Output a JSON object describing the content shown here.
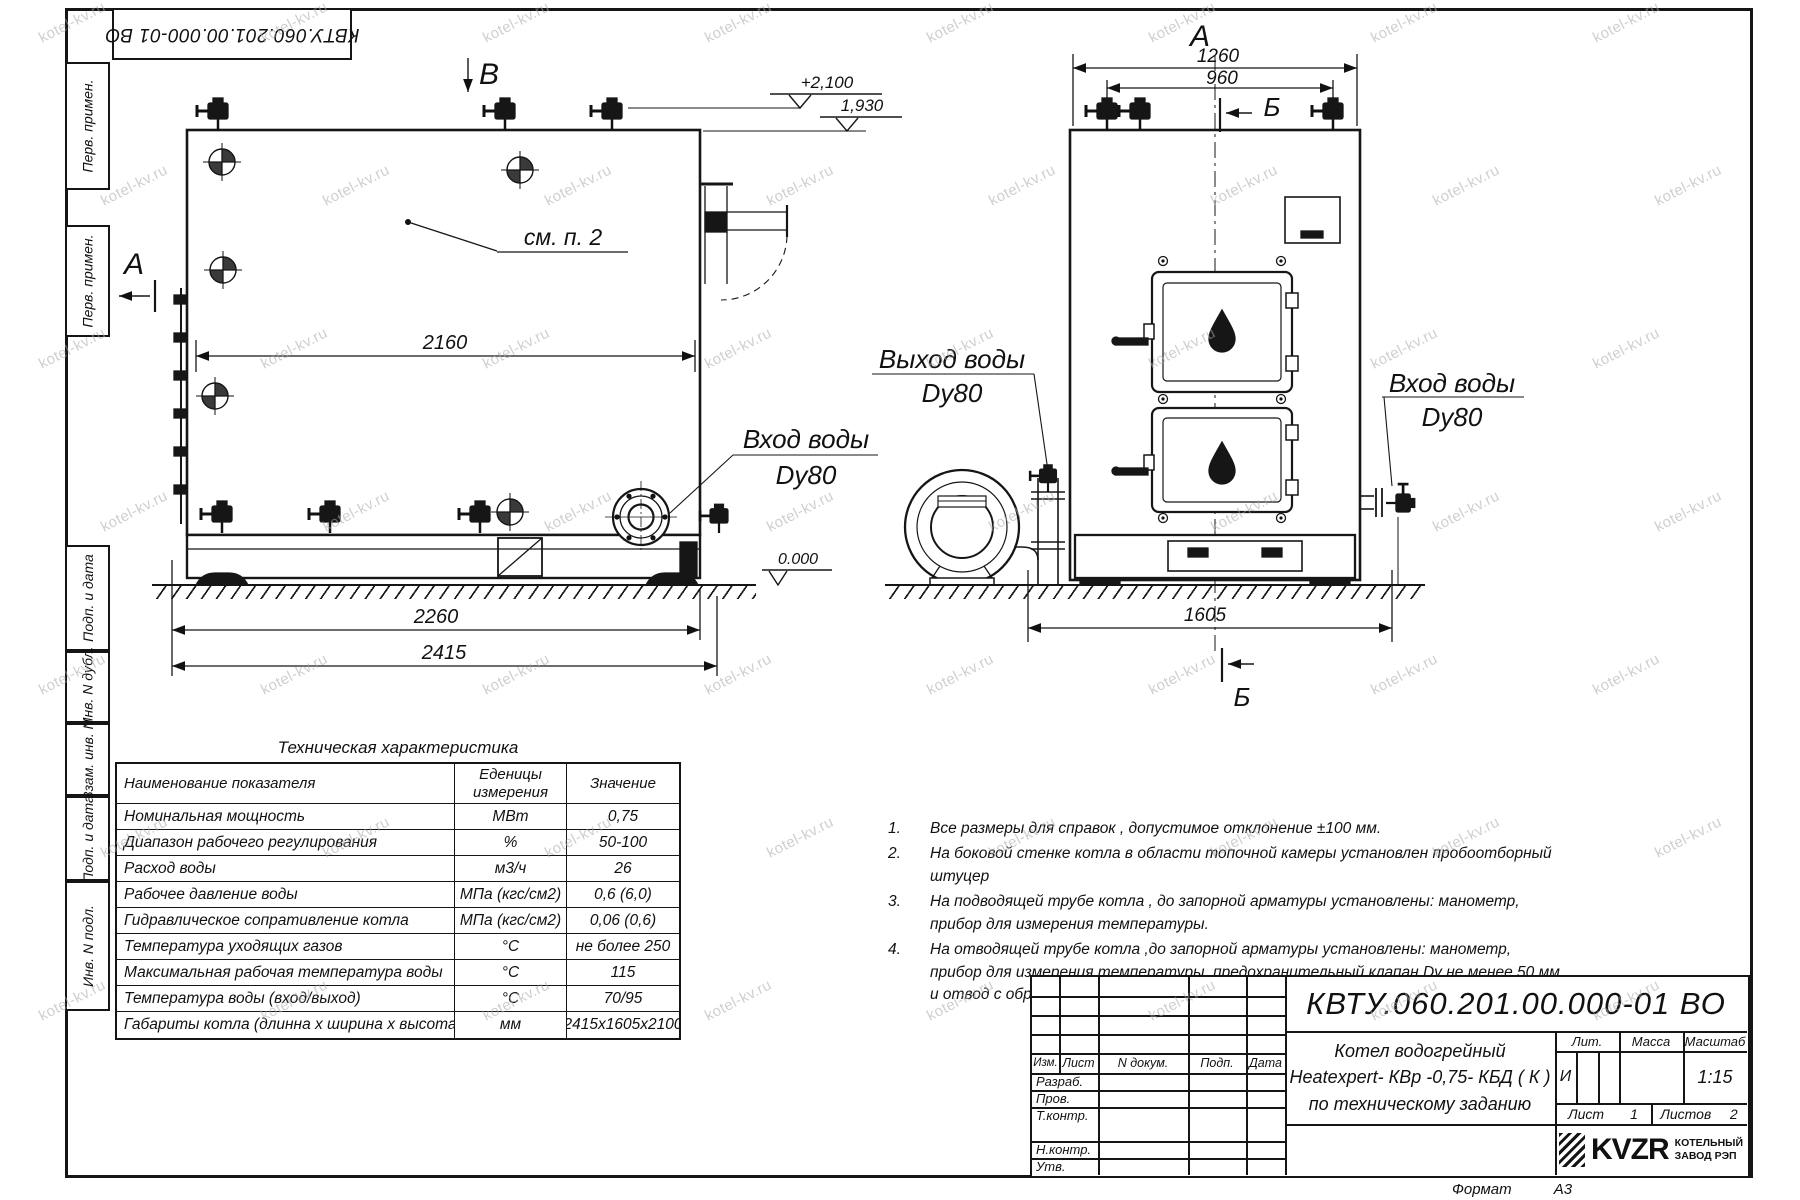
{
  "watermark": "kotel-kv.ru",
  "sheet": {
    "top_stamp": "КВТУ.060.201.00.000-01 ВО",
    "margin_labels": [
      "Перв. примен.",
      "Перв. примен.",
      "Подп. и дата",
      "Инв. N дубл.",
      "Взам. инв. N",
      "Подп. и дата",
      "Инв. N подл."
    ],
    "format_label": "Формат",
    "format_value": "А3"
  },
  "side_view": {
    "section_marker_b": "В",
    "section_marker_a": "А",
    "elevation_top": "+2,100",
    "elevation_mid": "1,930",
    "elevation_zero": "0.000",
    "callout_note": "см. п. 2",
    "dim_shell": "2160",
    "dim_base": "2260",
    "dim_overall": "2415",
    "inlet_line1": "Вход воды",
    "inlet_line2": "Dy80"
  },
  "front_view": {
    "view_label": "А",
    "dim_overall": "1260",
    "dim_valves": "960",
    "section_top": "Б",
    "section_bottom": "Б",
    "outlet_line1": "Выход воды",
    "outlet_line2": "Dy80",
    "inlet_line1": "Вход воды",
    "inlet_line2": "Dy80",
    "dim_depth": "1605"
  },
  "spec_table": {
    "title": "Техническая характеристика",
    "headers": [
      "Наименование показателя",
      "Еденицы\nизмерения",
      "Значение"
    ],
    "rows": [
      [
        "Номинальная мощность",
        "МВт",
        "0,75"
      ],
      [
        "Диапазон рабочего регулирования",
        "%",
        "50-100"
      ],
      [
        "Расход воды",
        "м3/ч",
        "26"
      ],
      [
        "Рабочее давление воды",
        "МПа (кгс/см2)",
        "0,6 (6,0)"
      ],
      [
        "Гидравлическое сопративление котла",
        "МПа (кгс/см2)",
        "0,06 (0,6)"
      ],
      [
        "Температура уходящих газов",
        "°С",
        "не более 250"
      ],
      [
        "Максимальная рабочая температура воды",
        "°С",
        "115"
      ],
      [
        "Температура воды (вход/выход)",
        "°С",
        "70/95"
      ],
      [
        "Габариты котла (длинна х ширина х высота)",
        "мм",
        "2415х1605х2100"
      ]
    ]
  },
  "notes": {
    "items": [
      {
        "num": "1.",
        "text": "Все размеры для справок , допустимое отклонение  ±100 мм."
      },
      {
        "num": "2.",
        "text": "На боковой стенке котла в области топочной камеры установлен пробоотборный штуцер"
      },
      {
        "num": "3.",
        "text": "На  подводящей трубе котла , до запорной арматуры установлены: манометр, прибор для измерения температуры."
      },
      {
        "num": "4.",
        "text": "На отводящей трубе котла ,до запорной арматуры установлены: манометр, прибор для измерения температуры, предохранительный клапан  Dу не менее  50 мм и отвод с обратным клапаном  Dу не менее  50 мм."
      }
    ]
  },
  "title_block": {
    "doc_number": "КВТУ.060.201.00.000-01  ВО",
    "product_line1": "Котел водогрейный",
    "product_line2": "Heatexpert- КВр -0,75- КБД ( К )",
    "product_line3": "по техническому заданию",
    "cols": {
      "izm": "Изм.",
      "list": "Лист",
      "doc": "N докум.",
      "sign": "Подп.",
      "date": "Дата"
    },
    "row_labels": {
      "dev": "Разраб.",
      "check": "Пров.",
      "tcontr": "Т.контр.",
      "ncontr": "Н.контр.",
      "approve": "Утв."
    },
    "lit_label": "Лит.",
    "lit_value": "И",
    "mass_label": "Масса",
    "scale_label": "Масштаб",
    "scale_value": "1:15",
    "sheet_label": "Лист",
    "sheet_value": "1",
    "sheets_label": "Листов",
    "sheets_value": "2",
    "logo_text": "KVZR",
    "logo_sub1": "КОТЕЛЬНЫЙ",
    "logo_sub2": "ЗАВОД РЭП"
  }
}
